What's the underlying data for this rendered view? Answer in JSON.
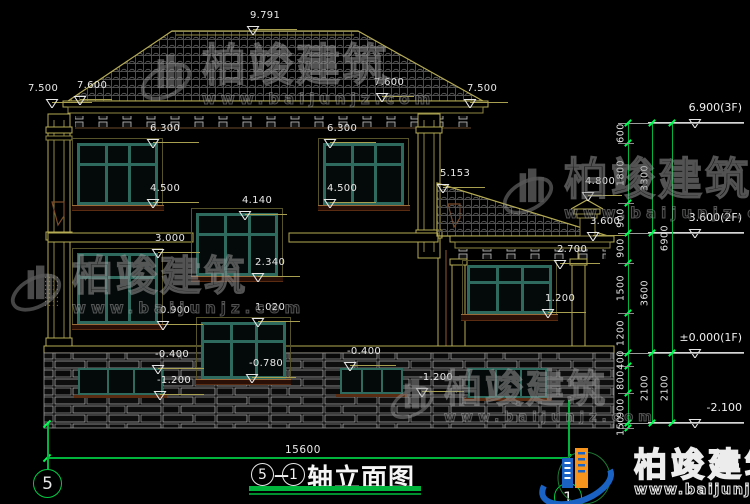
{
  "drawing": {
    "title_axis_start": "5",
    "title_axis_end": "1",
    "title_label": "轴立面图",
    "axis_bubble_left": "5",
    "axis_bubble_right": "1",
    "overall_width_dim": "15600"
  },
  "watermark": {
    "name": "柏竣建筑",
    "url": "www.baijunjz.com"
  },
  "brand_logo": {
    "name": "柏竣建筑",
    "url": "www.baijunjz.com"
  },
  "elevation_markers": [
    {
      "label": "9.791",
      "x": 253,
      "y": 30,
      "lw": 44
    },
    {
      "label": "7.500",
      "x": 52,
      "y": 103,
      "lw": 40,
      "tx": -24
    },
    {
      "label": "7.600",
      "x": 80,
      "y": 100,
      "lw": 32
    },
    {
      "label": "7.600",
      "x": 382,
      "y": 97,
      "lw": 32,
      "tx": -8
    },
    {
      "label": "7.500",
      "x": 470,
      "y": 103,
      "lw": 38
    },
    {
      "label": "6.300",
      "x": 153,
      "y": 143,
      "lw": 46
    },
    {
      "label": "6.300",
      "x": 330,
      "y": 143,
      "lw": 46
    },
    {
      "label": "4.500",
      "x": 153,
      "y": 203,
      "lw": 46
    },
    {
      "label": "4.500",
      "x": 330,
      "y": 203,
      "lw": 46
    },
    {
      "label": "5.153",
      "x": 443,
      "y": 188,
      "lw": 42
    },
    {
      "label": "4.140",
      "x": 245,
      "y": 215,
      "lw": 42
    },
    {
      "label": "4.800",
      "x": 588,
      "y": 196,
      "lw": 34
    },
    {
      "label": "3.600",
      "x": 593,
      "y": 236,
      "lw": 34
    },
    {
      "label": "3.000",
      "x": 158,
      "y": 253,
      "lw": 42
    },
    {
      "label": "2.700",
      "x": 560,
      "y": 264,
      "lw": 40
    },
    {
      "label": "2.340",
      "x": 258,
      "y": 277,
      "lw": 42
    },
    {
      "label": "1.020",
      "x": 258,
      "y": 322,
      "lw": 42
    },
    {
      "label": "0.900",
      "x": 163,
      "y": 325,
      "lw": 40
    },
    {
      "label": "1.200",
      "x": 548,
      "y": 313,
      "lw": 38
    },
    {
      "label": "-0.400",
      "x": 158,
      "y": 369,
      "lw": 46
    },
    {
      "label": "-0.780",
      "x": 252,
      "y": 378,
      "lw": 44
    },
    {
      "label": "-1.200",
      "x": 160,
      "y": 395,
      "lw": 44
    },
    {
      "label": "-0.400",
      "x": 350,
      "y": 366,
      "lw": 46
    },
    {
      "label": "-1.200",
      "x": 422,
      "y": 392,
      "lw": 42
    }
  ],
  "floor_markers": [
    {
      "label": "6.900(3F)",
      "y": 123
    },
    {
      "label": "3.600(2F)",
      "y": 233
    },
    {
      "label": "±0.000(1F)",
      "y": 353
    },
    {
      "label": "-2.100",
      "y": 423
    }
  ],
  "right_chain": {
    "major_levels": [
      123,
      233,
      353,
      423
    ],
    "cols": [
      {
        "x": 628,
        "levels": [
          123,
          143,
          203,
          233,
          263,
          313,
          353,
          366,
          393,
          423,
          428
        ],
        "labels": [
          "600",
          "1800",
          "900",
          "900",
          "1500",
          "1200",
          "400",
          "800",
          "900",
          "150"
        ]
      },
      {
        "x": 652,
        "levels": [
          123,
          233,
          353,
          423
        ],
        "labels": [
          "3300",
          "3600",
          "2100"
        ]
      },
      {
        "x": 672,
        "levels": [
          123,
          353,
          423
        ],
        "labels": [
          "6900",
          "2100"
        ]
      }
    ]
  }
}
